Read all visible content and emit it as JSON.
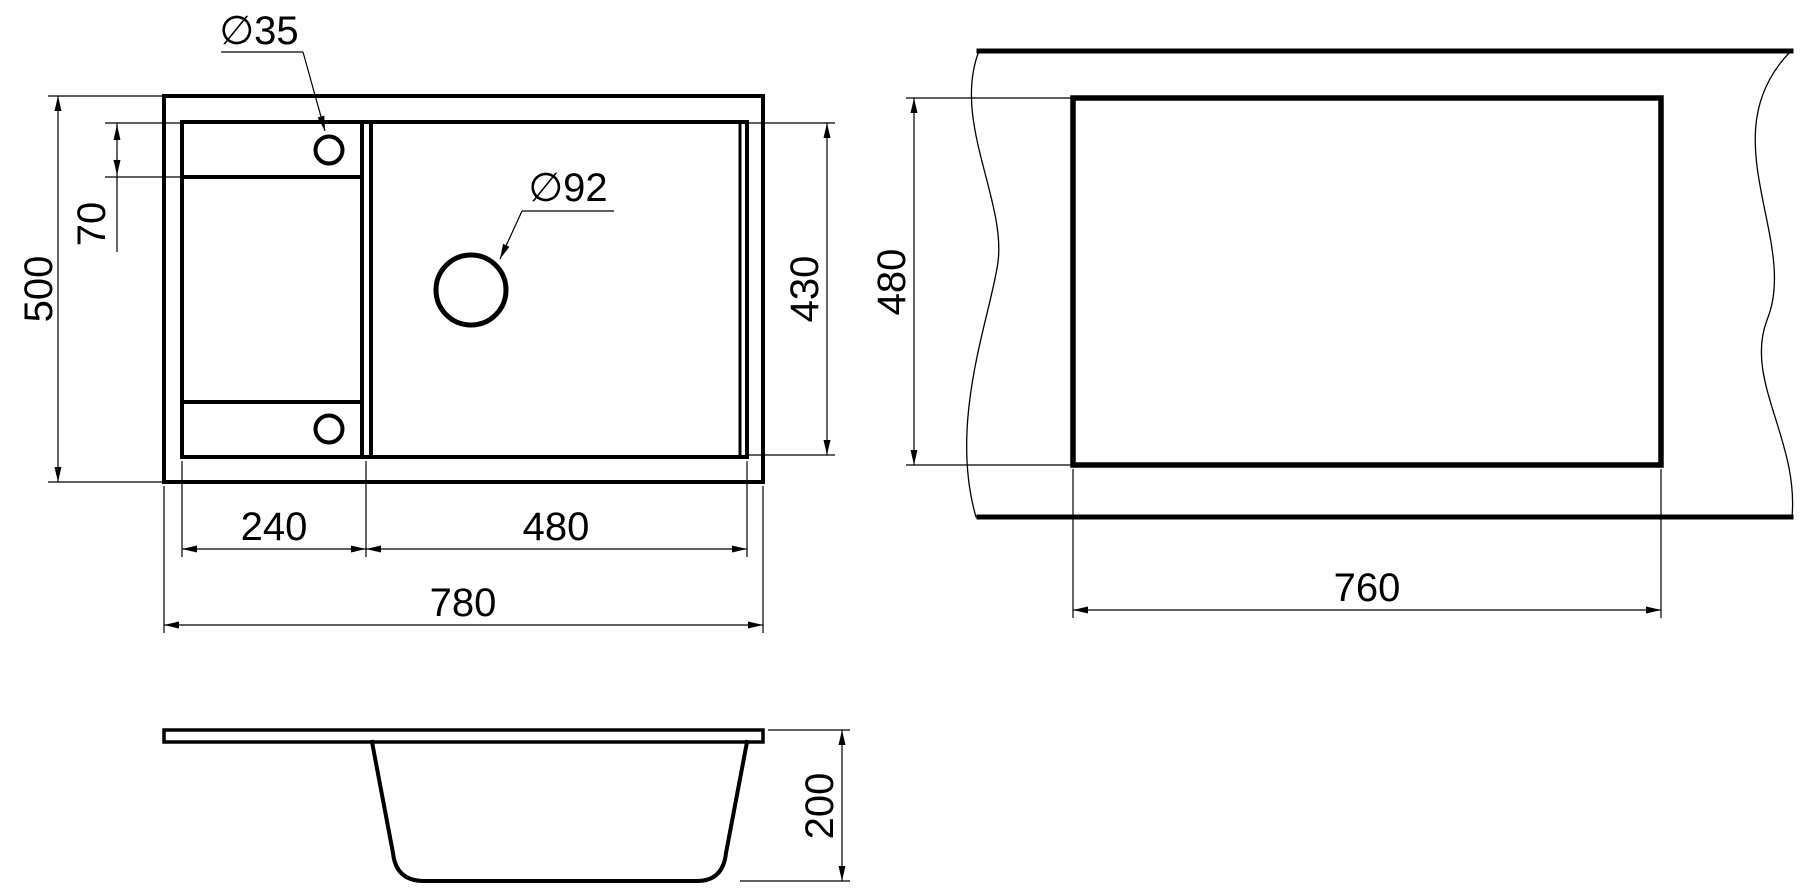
{
  "colors": {
    "line": "#000000",
    "background": "#ffffff"
  },
  "views": {
    "plan": {
      "width": "780",
      "height": "500",
      "drainboard_width": "240",
      "bowl_width": "480",
      "bowl_inner_depth": "430",
      "tap_strip_height": "70",
      "tap_hole_label": "∅35",
      "drain_hole_label": "∅92"
    },
    "cutout": {
      "width": "760",
      "height": "480"
    },
    "section": {
      "depth": "200"
    }
  }
}
